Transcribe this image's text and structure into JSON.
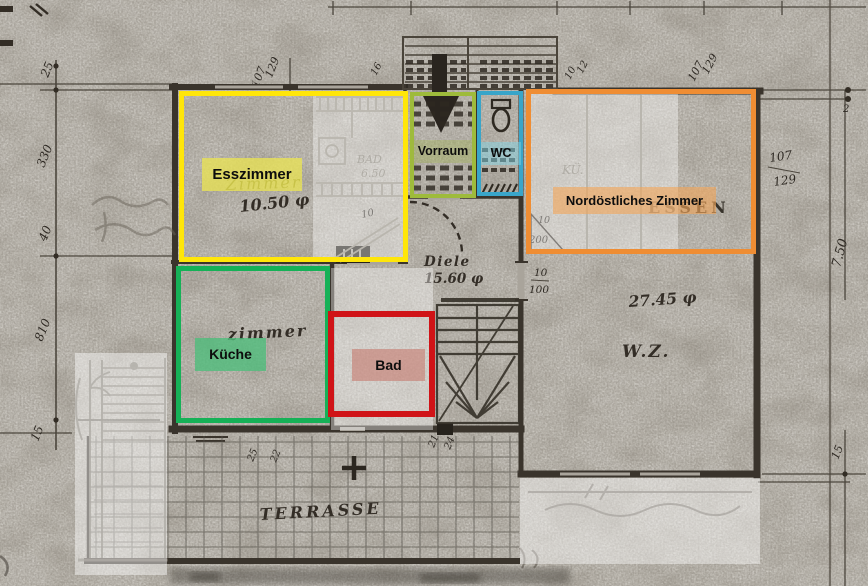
{
  "annotations": {
    "esszimmer": {
      "label": "Esszimmer",
      "color": "#ffe609"
    },
    "vorraum": {
      "label": "Vorraum",
      "color": "#9ebb3b"
    },
    "wc": {
      "label": "WC",
      "color": "#39a5c9"
    },
    "nordost": {
      "label": "Nordöstliches Zimmer",
      "color": "#ef8d33"
    },
    "kueche": {
      "label": "Küche",
      "color": "#16b157"
    },
    "bad": {
      "label": "Bad",
      "color": "#d01317"
    }
  },
  "plan": {
    "texts": {
      "zimmer_ess": "Zimmer",
      "ess_area": "10.50 φ",
      "bad_old": "BAD",
      "bad_old_area": "6.50",
      "diele": "Diele",
      "diele_area": "15.60 φ",
      "zimmer_kue": "zimmer",
      "kue": "KÜ.",
      "essen": "ESSEN",
      "wz_area": "27.45 φ",
      "wz": "W.Z.",
      "terrasse": "TERRASSE"
    },
    "dims": {
      "left": [
        "25",
        "330",
        "40",
        "810",
        "15"
      ],
      "top_frac1": [
        "107",
        "129"
      ],
      "top_small": "16",
      "top_pair": [
        "10",
        "12"
      ],
      "top_frac2": [
        "107",
        "129"
      ],
      "right_frac": [
        "107",
        "129"
      ],
      "right_small": "2",
      "right_height": "7.50",
      "right_lower": "15",
      "door_wz": [
        "10",
        "100"
      ],
      "door_nz": [
        "10",
        "200"
      ],
      "bath_small": "10",
      "terr_left": [
        "25",
        "22"
      ],
      "terr_right": [
        "21",
        "24"
      ]
    }
  }
}
